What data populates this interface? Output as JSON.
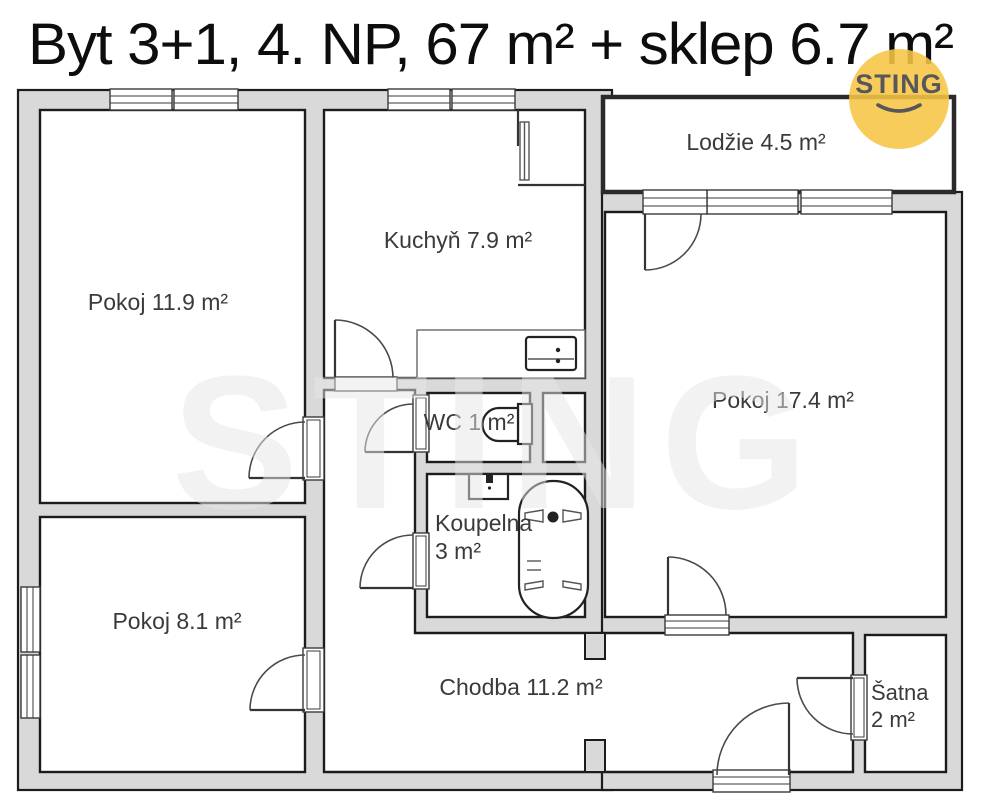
{
  "title": "Byt 3+1, 4. NP, 67 m² + sklep 6.7 m²",
  "watermark": "STING",
  "logo": {
    "text": "STING"
  },
  "colors": {
    "wall_fill": "#d9d9d9",
    "line": "#1c1c1c",
    "logo_yellow": "#f6c544",
    "logo_text": "#57575a",
    "label_text": "#3a3a3a"
  },
  "rooms": {
    "pokoj_a": {
      "label": "Pokoj 11.9 m²"
    },
    "kuchyn": {
      "label": "Kuchyň 7.9 m²"
    },
    "lodzie": {
      "label": "Lodžie 4.5 m²"
    },
    "pokoj_b": {
      "label": "Pokoj 17.4 m²"
    },
    "wc": {
      "label": "WC 1 m²"
    },
    "koupelna": {
      "line1": "Koupelna",
      "line2": "3 m²"
    },
    "pokoj_c": {
      "label": "Pokoj 8.1 m²"
    },
    "chodba": {
      "label": "Chodba 11.2 m²"
    },
    "satna": {
      "line1": "Šatna",
      "line2": "2 m²"
    }
  }
}
